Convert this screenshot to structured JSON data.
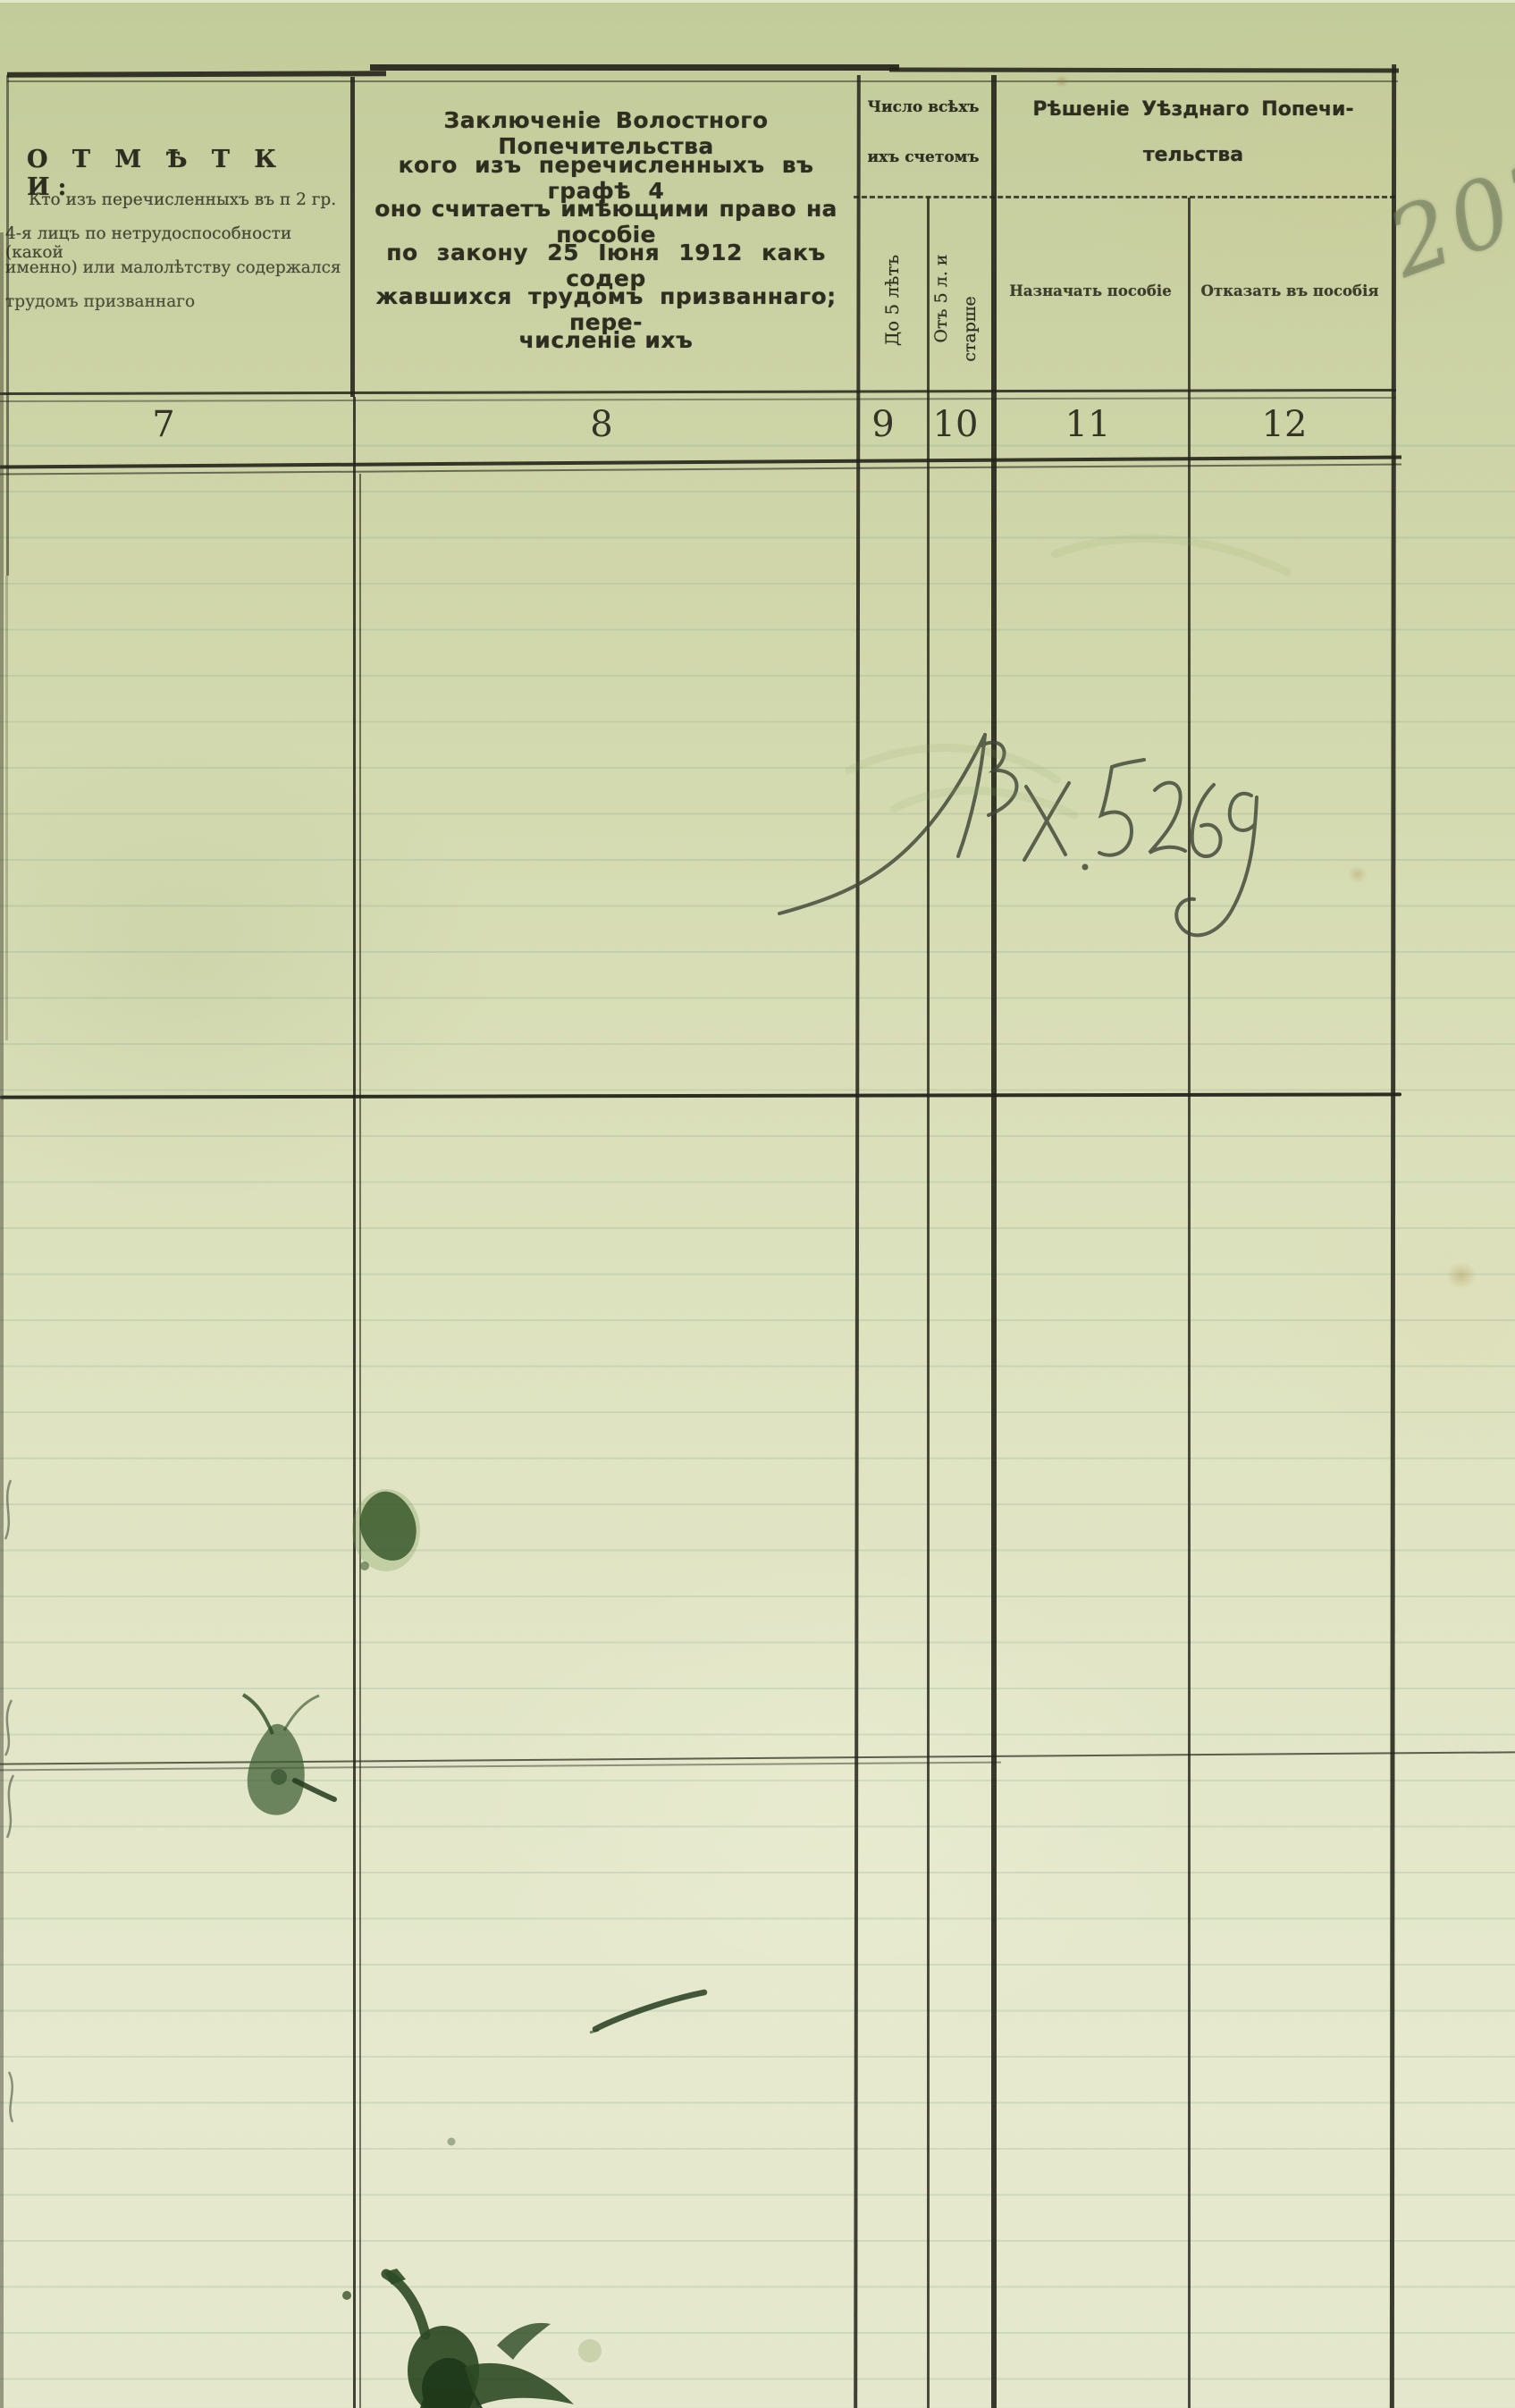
{
  "document": {
    "kind": "scanned archival ledger form (pre-1918 Russian orthography)",
    "annotations": {
      "page_number_pencil": "202",
      "registration_mark": "Вх. 5269"
    },
    "header": {
      "col7": {
        "number": "7",
        "title": "О Т М Ѣ Т К И:",
        "lines": [
          "Кто изъ перечисленныхъ въ п 2 гр.",
          "4-я лицъ по нетрудоспособности (какой",
          "именно) или малолѣтству содержался",
          "трудомъ призваннаго"
        ]
      },
      "col8": {
        "number": "8",
        "lines": [
          "Заключеніе Волостного Попечительства",
          "кого изъ перечисленныхъ въ графѣ 4",
          "оно считаетъ имѣющими право на пособіе",
          "по закону 25 Іюня 1912 какъ содер",
          "жавшихся трудомъ призваннаго; пере-",
          "численіе ихъ"
        ]
      },
      "group9_10": {
        "line1": "Число всѣхъ",
        "line2": "ихъ счетомъ"
      },
      "col9": {
        "number": "9",
        "label": "До 5 лѣтъ"
      },
      "col10": {
        "number": "10",
        "label_line1": "Отъ 5 л. и",
        "label_line2": "старше"
      },
      "group11_12": {
        "line1": "Рѣшеніе Уѣзднаго Попечи-",
        "line2": "тельства"
      },
      "col11": {
        "number": "11",
        "label": "Назначать пособіе"
      },
      "col12": {
        "number": "12",
        "label": "Отказать въ пособія"
      }
    },
    "colors": {
      "paper_top": "#c6cf9e",
      "paper_bottom": "#e6e9d0",
      "printed_ink": "#2a2a1e",
      "ruled_line": "#7d9b82",
      "green_ink_stain": "#2c4a24",
      "pen_ink": "#3f4637",
      "pencil": "#6e7858"
    }
  }
}
